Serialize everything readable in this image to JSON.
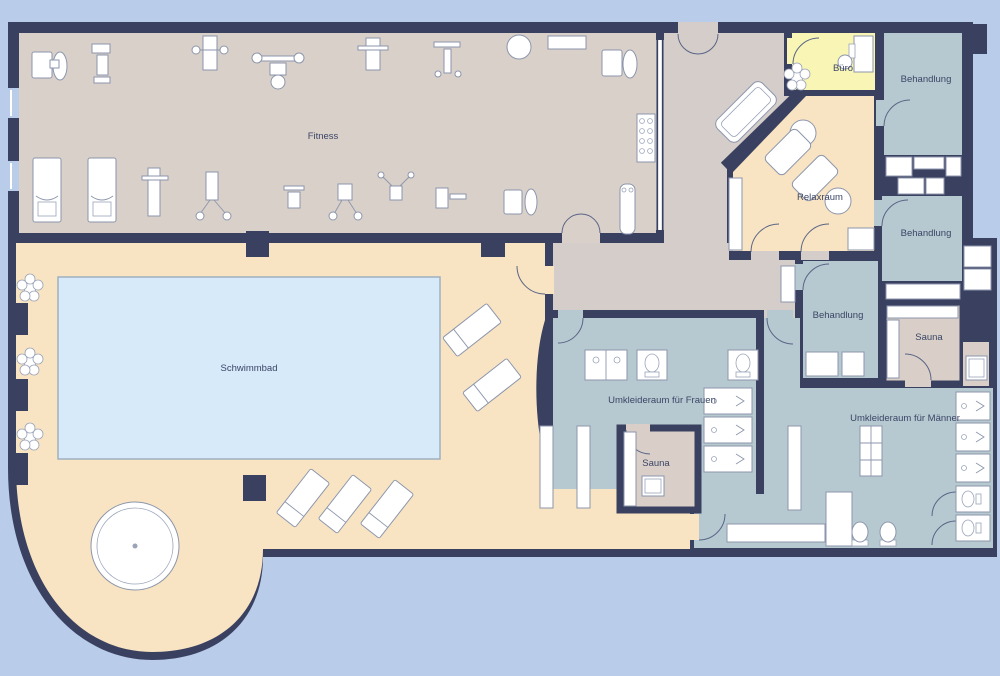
{
  "plan": {
    "type": "floor-plan",
    "building": "Fitness- und Wellnessbereich",
    "rooms": {
      "fitness": {
        "label": "Fitness"
      },
      "schwimmbad": {
        "label": "Schwimmbad"
      },
      "buero": {
        "label": "Büro"
      },
      "behandlung_1": {
        "label": "Behandlung"
      },
      "behandlung_2": {
        "label": "Behandlung"
      },
      "behandlung_3": {
        "label": "Behandlung"
      },
      "relaxraum": {
        "label": "Relaxraum"
      },
      "sauna_herren": {
        "label": "Sauna"
      },
      "sauna_damen": {
        "label": "Sauna"
      },
      "umkleide_frauen": {
        "label": "Umkleideraum für Frauen"
      },
      "umkleide_maenner": {
        "label": "Umkleideraum für Männer"
      }
    },
    "colors": {
      "wall": "#3A4060",
      "background": "#B9CCEA",
      "fitness_floor": "#D9D0C9",
      "hallway_floor": "#D4CDC9",
      "pool_deck": "#F8E4C2",
      "pool_water": "#D7EAFA",
      "office_floor": "#F9F6B5",
      "treatment_floor": "#B7C9D0",
      "sauna_floor": "#D9CFC8",
      "furniture": "#FFFFFF",
      "label_text": "#3A4566"
    },
    "icons": [
      "plant-icon",
      "lounger-icon",
      "whirlpool-icon",
      "toilet-icon",
      "shower-icon",
      "sink-icon",
      "locker-icon",
      "bench-icon",
      "sofa-icon",
      "armchair-icon",
      "side-table-icon",
      "desk-icon",
      "sauna-heater-icon",
      "treadmill-icon",
      "weight-bench-icon",
      "exercise-machine-icon",
      "dumbbell-rack-icon",
      "door-swing-icon",
      "pillar",
      "window"
    ]
  }
}
